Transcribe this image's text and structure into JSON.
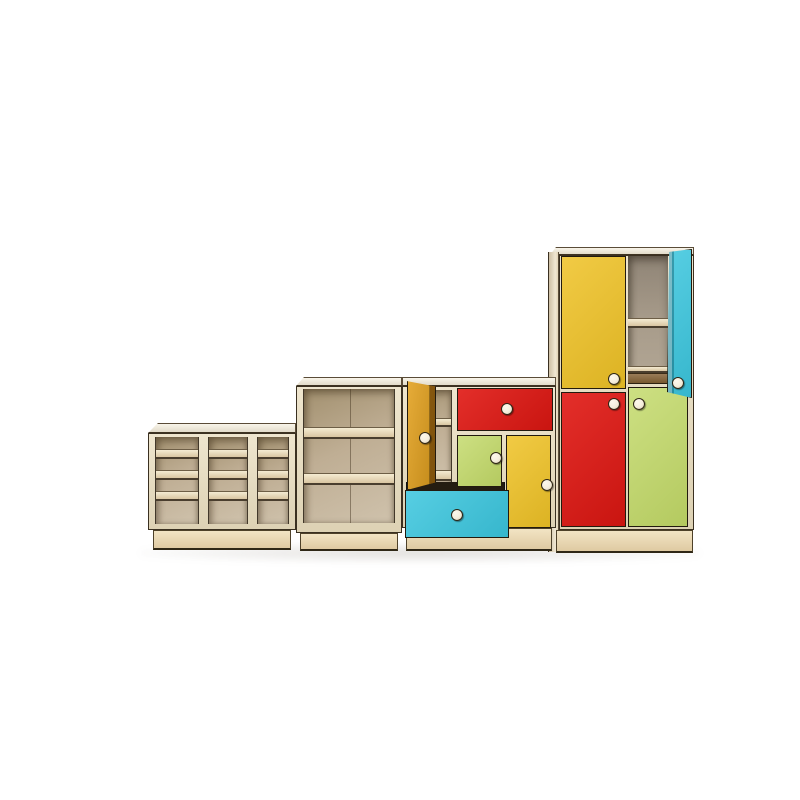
{
  "scene": {
    "type": "3d-product-render",
    "subject": "children's modular storage furniture set of four stepped units",
    "background": "#ffffff"
  },
  "palette": {
    "background": "#ffffff",
    "red": "#e01712",
    "yellow": "#efc226",
    "orange": "#e2a01d",
    "lime": "#c2d967",
    "cyan": "#3bc6de",
    "birch_top": "#f3ecd9",
    "birch_frame": "#e9ddbe",
    "plinth": "#e8d7b4",
    "interior_warm": "#c5b69e",
    "interior_gray": "#a89c8c",
    "shelf_edge": "#eee3c4",
    "wood_dark": "#8a6c4c",
    "outline": "#241c10",
    "knob": "#f5eedd"
  },
  "units": [
    {
      "id": "cubby-unit",
      "label": "low open cubby shelf",
      "columns": 3,
      "rows": 4,
      "material": "birch plywood"
    },
    {
      "id": "bookshelf",
      "label": "open bookshelf",
      "shelf_bays": 3,
      "material": "birch plywood"
    },
    {
      "id": "mixed-cabinet",
      "label": "cabinet with doors and drawers",
      "parts": [
        "open-orange-door",
        "red-drawer",
        "lime-door",
        "yellow-door",
        "open-cyan-drawer"
      ],
      "knobs": 5
    },
    {
      "id": "wardrobe",
      "label": "tall wardrobe",
      "parts": [
        "yellow-door",
        "open-shelf-bay",
        "open-cyan-door",
        "red-door",
        "lime-door"
      ],
      "knobs": 4
    }
  ]
}
